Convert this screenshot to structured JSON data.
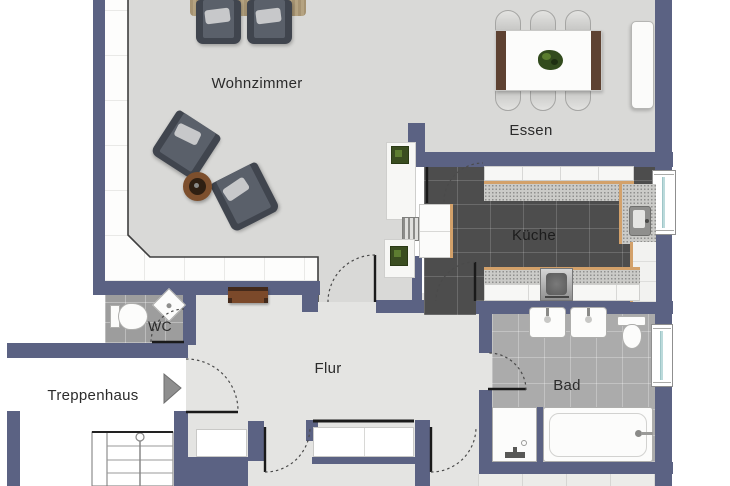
{
  "rooms": {
    "wohnzimmer": {
      "label": "Wohnzimmer"
    },
    "essen": {
      "label": "Essen"
    },
    "kueche": {
      "label": "Küche"
    },
    "flur": {
      "label": "Flur"
    },
    "wc": {
      "label": "WC"
    },
    "bad": {
      "label": "Bad"
    },
    "treppenhaus": {
      "label": "Treppenhaus"
    }
  },
  "colors": {
    "wall": "#5b6283",
    "living_dining_floor": "#d9d9d7",
    "hall_floor": "#e4e4e2",
    "kitchen_tile": "#4d4d4d",
    "wc_tile": "#9d9d9d",
    "bad_tile": "#ababab",
    "countertop": "#cbcbc8",
    "counter_edge": "#d3a16a",
    "table_wood": "#5e4232",
    "window_glass": "#bcdadb"
  },
  "furniture": {
    "wohnzimmer": [
      "rug",
      "armchair",
      "armchair",
      "armchair",
      "armchair",
      "side-table"
    ],
    "essen": [
      "dining-table",
      "table-plant",
      "chair",
      "chair",
      "chair",
      "chair",
      "chair",
      "chair",
      "sideboard",
      "shelf-with-plants",
      "radiator"
    ],
    "kueche": [
      "counter",
      "island",
      "kitchen-sink",
      "stove"
    ],
    "flur": [
      "wall-console"
    ],
    "wc": [
      "toilet",
      "corner-sink"
    ],
    "bad": [
      "sink",
      "sink",
      "toilet",
      "shower",
      "bathtub"
    ],
    "treppenhaus": [
      "stairs",
      "entrance-arrow"
    ]
  }
}
